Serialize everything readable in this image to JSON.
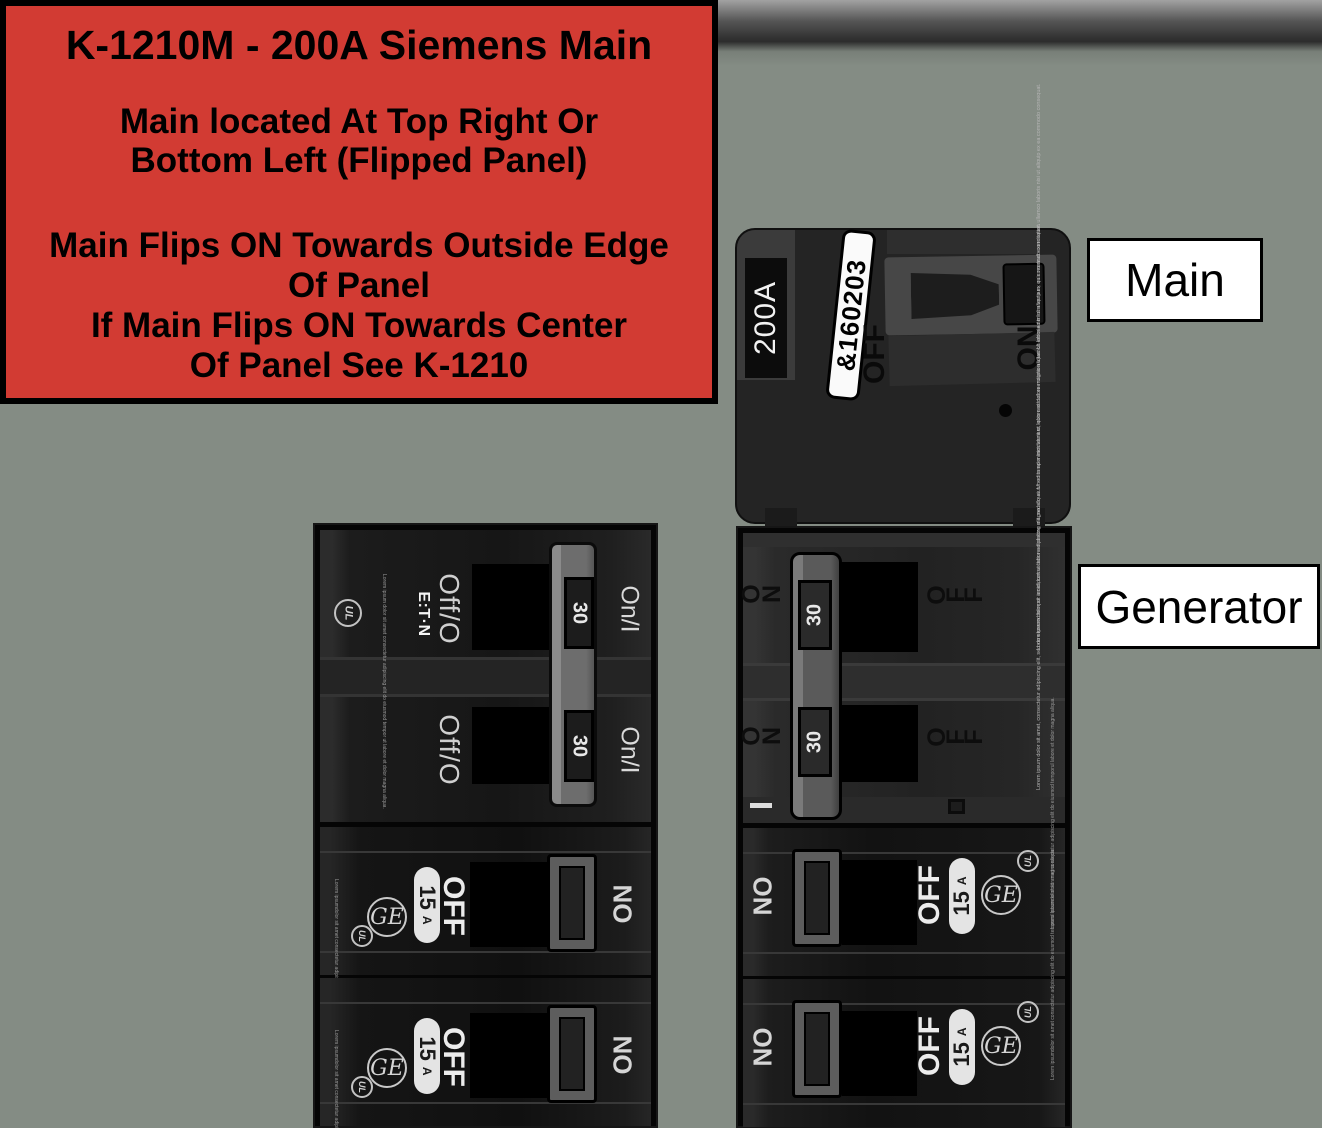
{
  "instruction_box": {
    "title": "K-1210M - 200A Siemens Main",
    "para1": [
      "Main located At Top Right Or",
      "Bottom Left (Flipped Panel)"
    ],
    "para2": [
      "Main Flips ON Towards Outside Edge",
      "Of Panel",
      "If Main Flips ON Towards Center",
      "Of Panel See K-1210"
    ]
  },
  "side_labels": {
    "main": "Main",
    "generator": "Generator"
  },
  "main_breaker": {
    "amp": "200A",
    "sticker": "&160203",
    "off": "OFF",
    "on": "ON"
  },
  "left_column": {
    "eaton_double": {
      "brand": "E:T·N",
      "ul": "UL",
      "amp": "30",
      "off": "Off/O",
      "on": "On/I",
      "fine_print": "Lorem ipsum dolor sit amet consectetur adipiscing elit do eiusmod tempor ut labore et dolor magna aliqua."
    },
    "ge_single": {
      "brand": "GE",
      "ul": "UL",
      "amp": "15",
      "amp_unit": "A",
      "off": "OFF",
      "on": "ON",
      "fine_print": "Lorem ipsumdolor sit amet consectetur adipiscing elit do eiusmod temporul labore et dolor magna aliqua."
    }
  },
  "right_column": {
    "double_30": {
      "amp": "30",
      "off": "OFF",
      "on": "ON",
      "fine_print": "Lorem ipsum dolor sit amet, consectetur adipiscing elit, sed do eiusmod tempor incididunt ut labore et dolore magna aliqua. Ut enim ad minim veniam, quis nostrud exercitation ullamco laboris nisi ut aliquip ex ea commodo consequat."
    },
    "ge_single": {
      "brand": "GE",
      "ul": "UL",
      "amp": "15",
      "amp_unit": "A",
      "off": "OFF",
      "on": "ON",
      "fine_print": "Lorem ipsumdolor sit amet consectetur adipiscing elit do eiusmod temporul labore et dolor magna aliqua."
    }
  },
  "colors": {
    "background": "#848c84",
    "alert_red": "#d23b33",
    "label_bg": "#ffffff",
    "breaker_black": "#1a1a1a",
    "handle_gray": "#6d6d6d"
  }
}
